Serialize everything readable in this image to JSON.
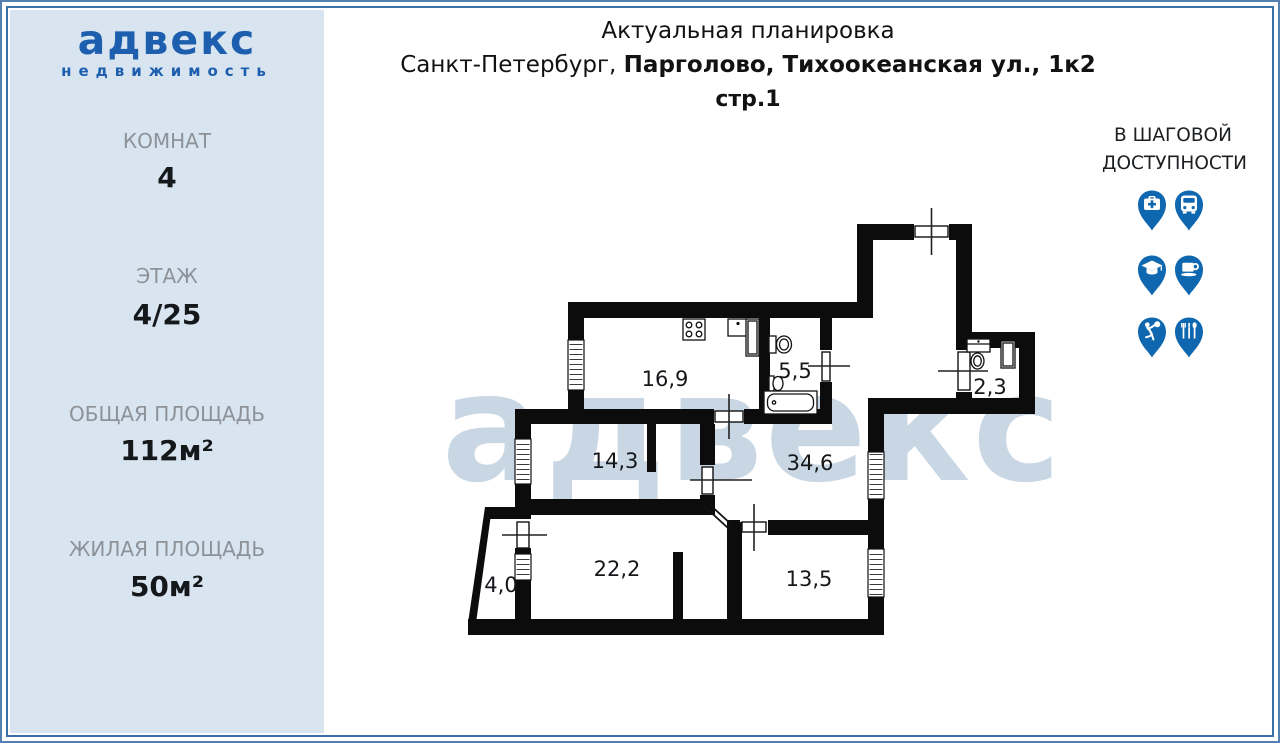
{
  "page": {
    "bg": "#ffffff",
    "frame_outer": "#5480b1",
    "frame_inner": "#3b70a6"
  },
  "logo": {
    "brand": "адвекс",
    "subtitle": "недвижимость",
    "color": "#1d5fae"
  },
  "sidebar": {
    "bg": "#d8e4f0",
    "stats": [
      {
        "label": "КОМНАТ",
        "value": "4"
      },
      {
        "label": "ЭТАЖ",
        "value": "4/25"
      },
      {
        "label": "ОБЩАЯ ПЛОЩАДЬ",
        "value": "112м²"
      },
      {
        "label": "ЖИЛАЯ ПЛОЩАДЬ",
        "value": "50м²"
      }
    ]
  },
  "header": {
    "title": "Актуальная планировка",
    "address_regular": "Санкт-Петербург, ",
    "address_bold": "Парголово, Тихоокеанская ул., 1к2",
    "building": "стр.1"
  },
  "nearby": {
    "heading_line1": "В ШАГОВОЙ",
    "heading_line2": "ДОСТУПНОСТИ",
    "pin_color": "#0e67af",
    "pins": [
      {
        "name": "pharmacy"
      },
      {
        "name": "bus-stop"
      },
      {
        "name": "school"
      },
      {
        "name": "cafe"
      },
      {
        "name": "sports"
      },
      {
        "name": "restaurant"
      }
    ]
  },
  "floorplan": {
    "watermark": "адвекс",
    "wall_color": "#0c0c0c",
    "rooms": [
      {
        "name": "kitchen",
        "area": "16,9"
      },
      {
        "name": "bathroom",
        "area": "5,5"
      },
      {
        "name": "wc",
        "area": "2,3"
      },
      {
        "name": "hallway",
        "area": "14,3"
      },
      {
        "name": "hall",
        "area": "34,6"
      },
      {
        "name": "living-room",
        "area": "22,2"
      },
      {
        "name": "room",
        "area": "13,5"
      },
      {
        "name": "balcony",
        "area": "4,0"
      }
    ]
  }
}
